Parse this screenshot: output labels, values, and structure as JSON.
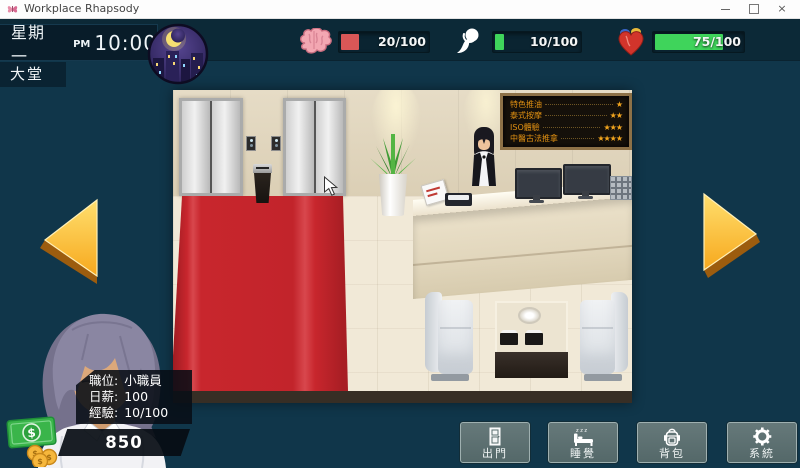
{
  "window": {
    "title": "Workplace Rhapsody",
    "close_glyph": "×"
  },
  "hud": {
    "day": "星期一",
    "meridiem": "PM",
    "time": "10:00",
    "location": "大堂",
    "stats": [
      {
        "icon": "brain-icon",
        "value": "20/100",
        "fill": "20%",
        "color": "#d95757"
      },
      {
        "icon": "soul-icon",
        "value": "10/100",
        "fill": "10%",
        "color": "#3fd45b"
      },
      {
        "icon": "heart-icon",
        "value": "75/100",
        "fill": "75%",
        "color": "#3fd45b"
      }
    ]
  },
  "scene": {
    "menu_board": {
      "items": [
        {
          "label": "特色推油",
          "stars": "★"
        },
        {
          "label": "泰式按摩",
          "stars": "★★"
        },
        {
          "label": "ISO體驗",
          "stars": "★★★"
        },
        {
          "label": "中醫古法推拿",
          "stars": "★★★★"
        }
      ]
    }
  },
  "player": {
    "rows": [
      {
        "label": "職位:",
        "value": "小職員"
      },
      {
        "label": "日薪:",
        "value": "100"
      },
      {
        "label": "經驗:",
        "value": "10/100"
      }
    ],
    "money": "850"
  },
  "actions": [
    {
      "label": "出門"
    },
    {
      "label": "睡覺"
    },
    {
      "label": "背包"
    },
    {
      "label": "系統"
    }
  ],
  "colors": {
    "bar_red": "#d95757",
    "bar_green": "#3fd45b",
    "carpet_red": "#c8262d",
    "arrow_gold": "#f7a81d",
    "money_green": "#3ab54a"
  }
}
